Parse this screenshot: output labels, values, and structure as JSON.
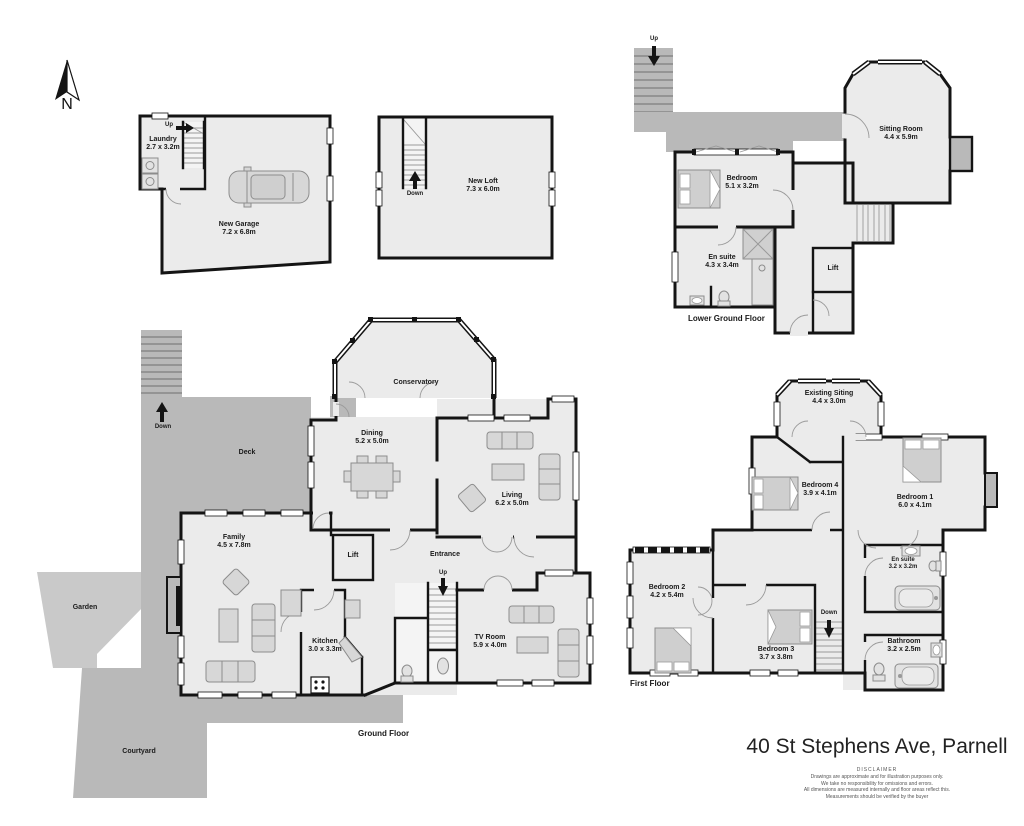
{
  "title": "40 St Stephens Ave, Parnell",
  "compass": {
    "label": "N"
  },
  "disclaimer": {
    "heading": "DISCLAIMER",
    "line1": "Drawings are approximate and for illustration purposes only.",
    "line2": "We take no responsibility for omissions and errors.",
    "line3": "All dimensions are measured internally and floor areas reflect this.",
    "line4": "Measurements should be verified by the buyer"
  },
  "colors": {
    "wall": "#141414",
    "room_fill": "#ebebeb",
    "outdoor_fill": "#b9b9b9",
    "garden_fill": "#c9c9c9"
  },
  "floors": {
    "garage": {
      "stairs_label": "Up",
      "rooms": {
        "laundry": {
          "name": "Laundry",
          "dims": "2.7 x 3.2m"
        },
        "new_garage": {
          "name": "New Garage",
          "dims": "7.2 x 6.8m"
        }
      }
    },
    "loft": {
      "stairs_label": "Down",
      "rooms": {
        "new_loft": {
          "name": "New Loft",
          "dims": "7.3 x 6.0m"
        }
      }
    },
    "lower_ground": {
      "label": "Lower Ground Floor",
      "stairs_label": "Up",
      "rooms": {
        "bedroom": {
          "name": "Bedroom",
          "dims": "5.1 x 3.2m"
        },
        "sitting_room": {
          "name": "Sitting Room",
          "dims": "4.4 x 5.9m"
        },
        "en_suite": {
          "name": "En suite",
          "dims": "4.3 x 3.4m"
        },
        "lift": {
          "name": "Lift"
        }
      }
    },
    "ground": {
      "label": "Ground Floor",
      "stairs_down_label": "Down",
      "stairs_up_label": "Up",
      "outdoor": {
        "deck": "Deck",
        "garden": "Garden",
        "courtyard": "Courtyard"
      },
      "rooms": {
        "conservatory": {
          "name": "Conservatory"
        },
        "dining": {
          "name": "Dining",
          "dims": "5.2 x 5.0m"
        },
        "living": {
          "name": "Living",
          "dims": "6.2 x 5.0m"
        },
        "family": {
          "name": "Family",
          "dims": "4.5 x 7.8m"
        },
        "kitchen": {
          "name": "Kitchen",
          "dims": "3.0 x 3.3m"
        },
        "entrance": {
          "name": "Entrance"
        },
        "tv_room": {
          "name": "TV Room",
          "dims": "5.9 x 4.0m"
        },
        "lift": {
          "name": "Lift"
        }
      }
    },
    "first": {
      "label": "First Floor",
      "stairs_label": "Down",
      "rooms": {
        "existing_siting": {
          "name": "Existing Siting",
          "dims": "4.4 x 3.0m"
        },
        "bedroom_1": {
          "name": "Bedroom 1",
          "dims": "6.0 x 4.1m"
        },
        "bedroom_2": {
          "name": "Bedroom 2",
          "dims": "4.2 x 5.4m"
        },
        "bedroom_3": {
          "name": "Bedroom 3",
          "dims": "3.7 x 3.8m"
        },
        "bedroom_4": {
          "name": "Bedroom 4",
          "dims": "3.9 x 4.1m"
        },
        "en_suite": {
          "name": "En suite",
          "dims": "3.2 x 3.2m"
        },
        "bathroom": {
          "name": "Bathroom",
          "dims": "3.2 x 2.5m"
        }
      }
    }
  }
}
